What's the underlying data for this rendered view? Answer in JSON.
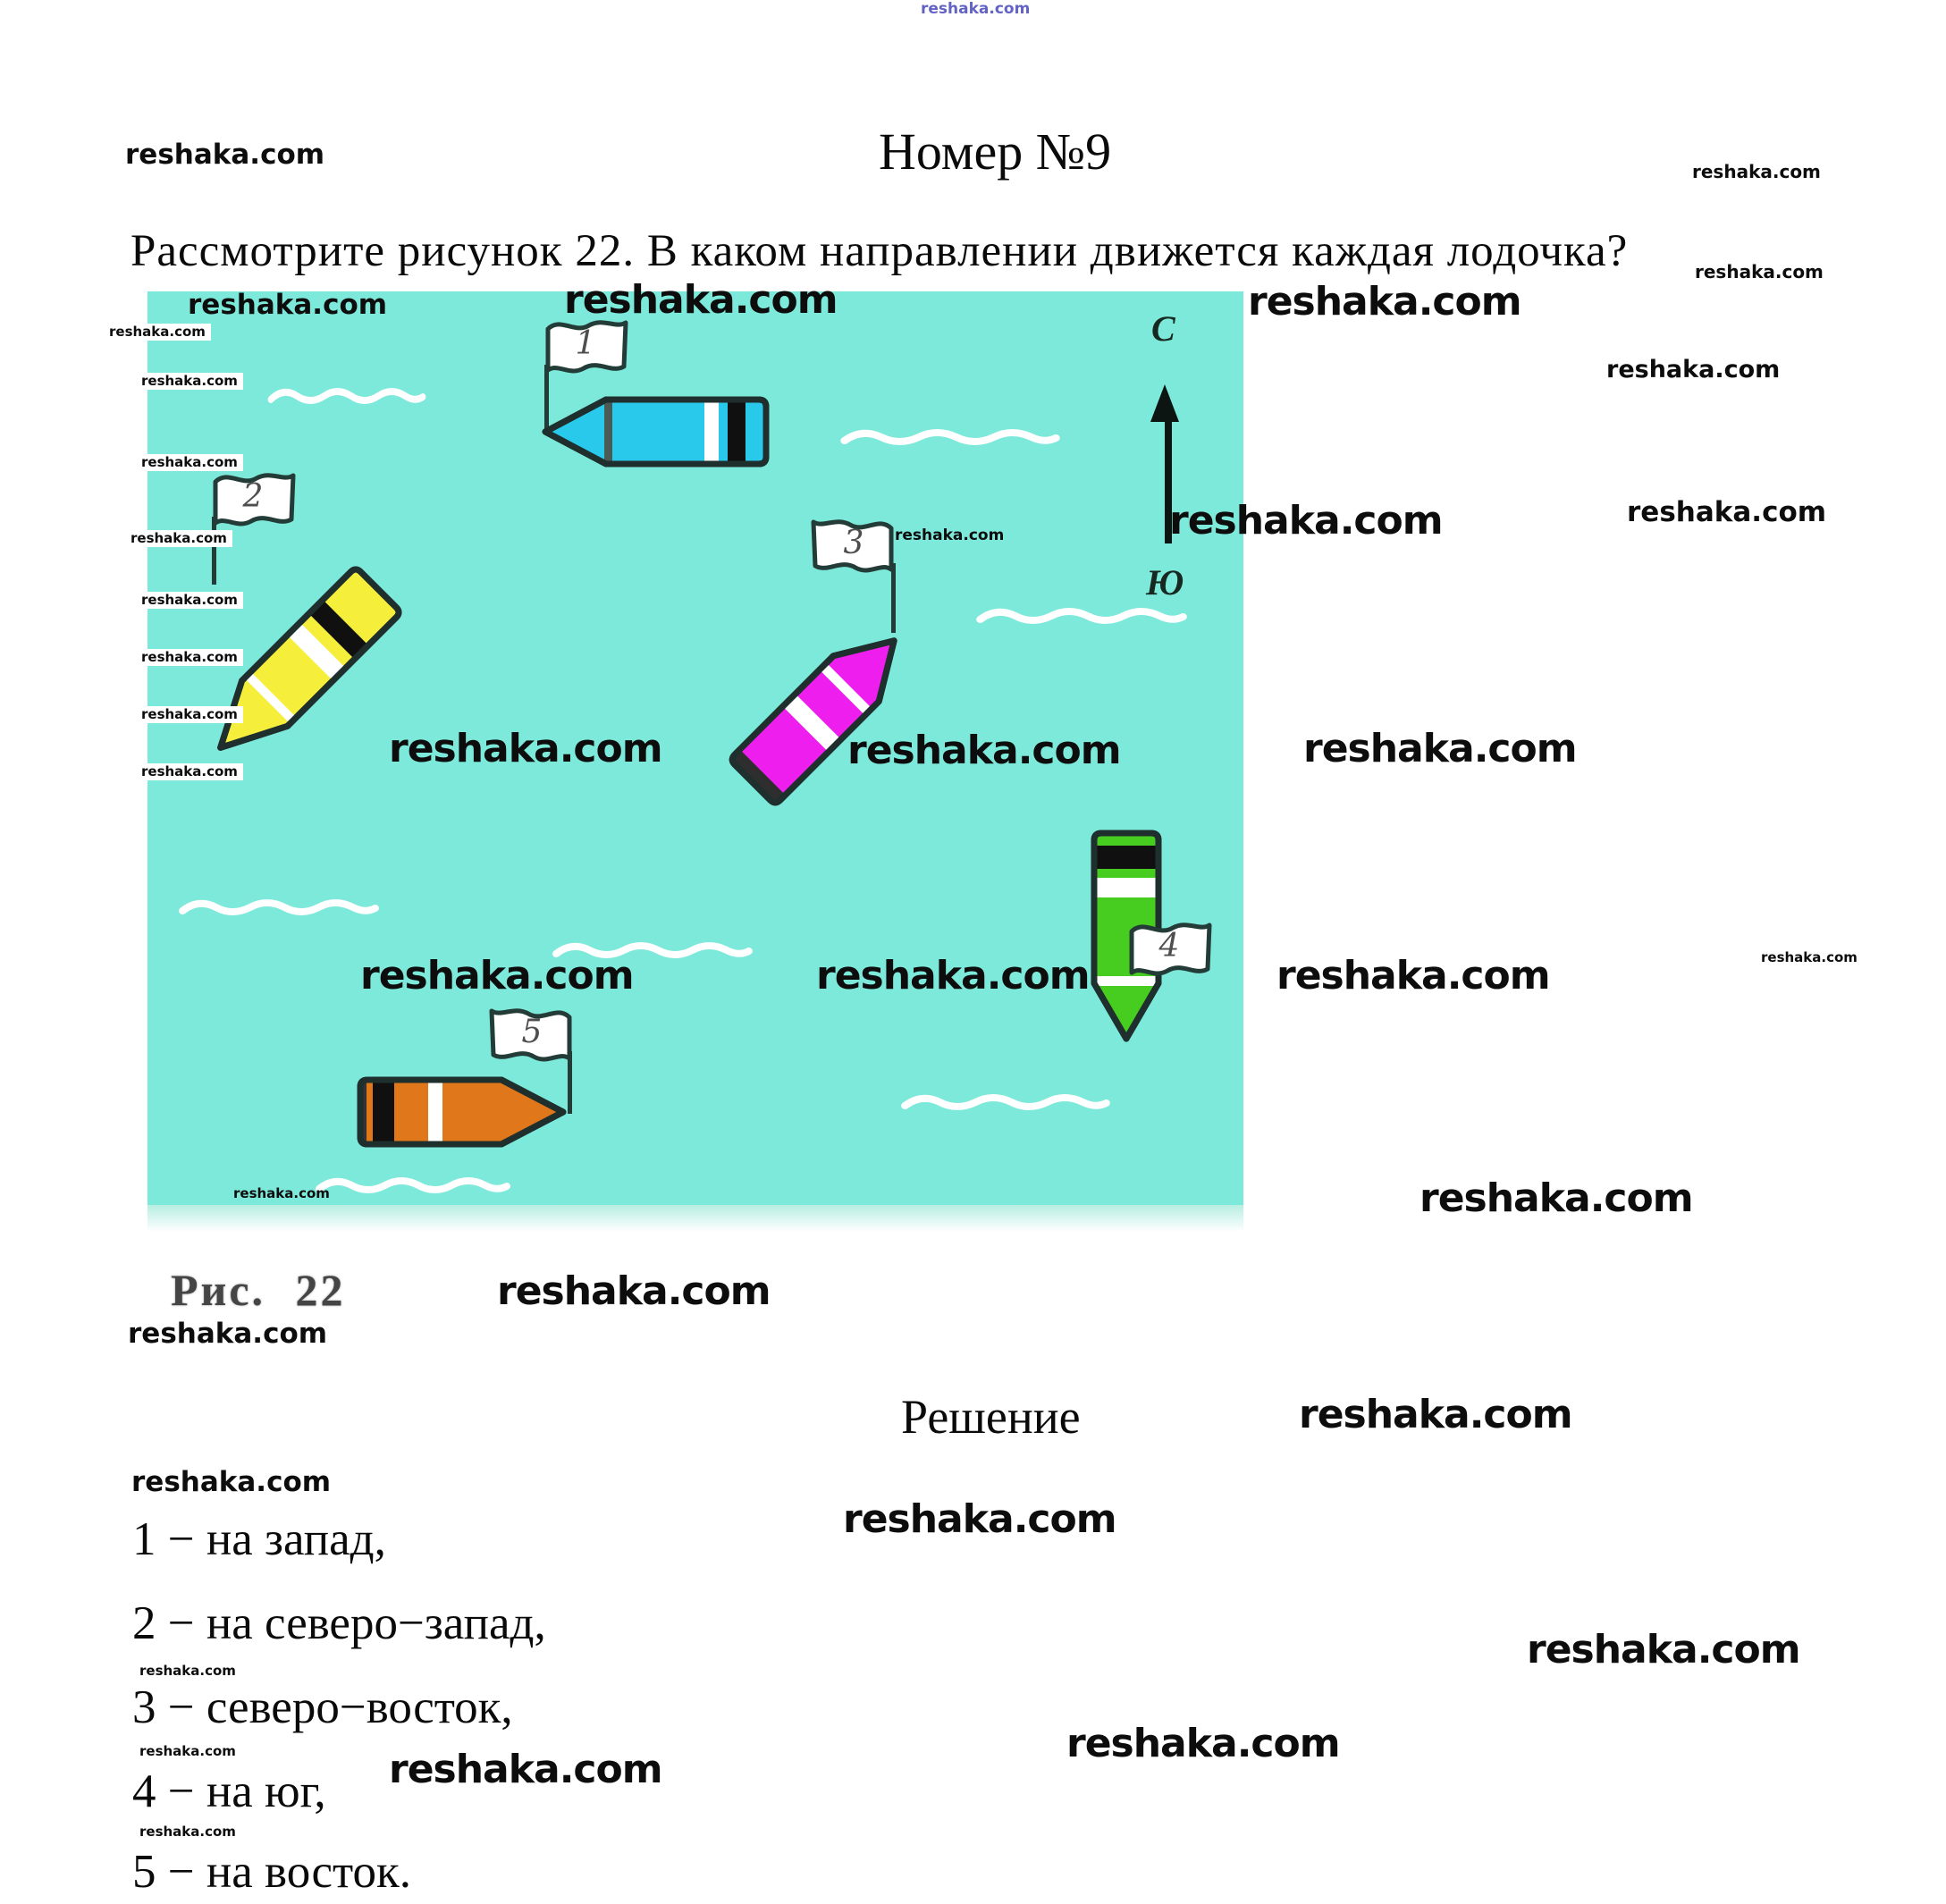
{
  "watermark": {
    "text": "reshaka.com",
    "color_blue": "#5353c0"
  },
  "title": "Номер №9",
  "question": "Рассмотрите рисунок 22. В каком направлении движется каждая лодочка?",
  "figure": {
    "background": "#7de9da",
    "compass": {
      "north": "С",
      "south": "Ю"
    },
    "boats": [
      {
        "number": "1",
        "color": "#29c9ec"
      },
      {
        "number": "2",
        "color": "#f5ee3b"
      },
      {
        "number": "3",
        "color": "#ee1fee"
      },
      {
        "number": "4",
        "color": "#47cd20"
      },
      {
        "number": "5",
        "color": "#e0771b"
      }
    ]
  },
  "caption": "Рис. 22",
  "solution": {
    "heading": "Решение",
    "answers": [
      "1 − на запад,",
      "2 − на северо−запад,",
      "3 − северо−восток,",
      "4 − на юг,",
      "5 − на восток."
    ]
  }
}
